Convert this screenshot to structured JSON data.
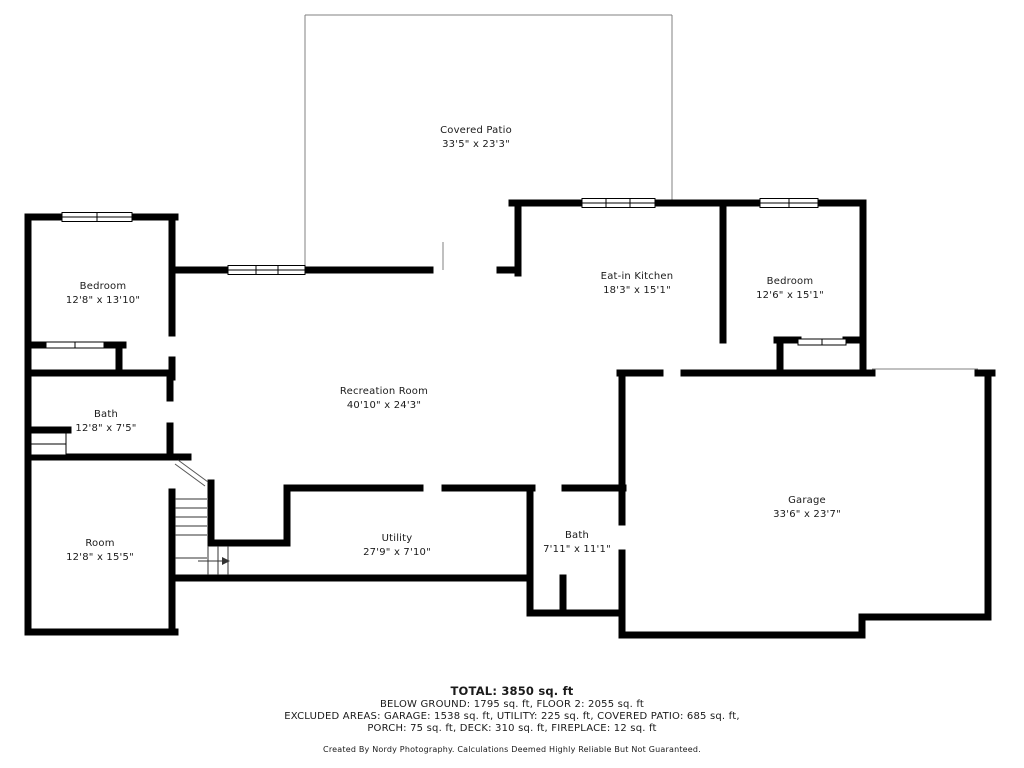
{
  "floorplan": {
    "rooms": {
      "covered_patio": {
        "name": "Covered Patio",
        "dims": "33'5\" x 23'3\""
      },
      "bedroom_left": {
        "name": "Bedroom",
        "dims": "12'8\" x 13'10\""
      },
      "eat_in_kitchen": {
        "name": "Eat-in Kitchen",
        "dims": "18'3\" x 15'1\""
      },
      "bedroom_right": {
        "name": "Bedroom",
        "dims": "12'6\" x 15'1\""
      },
      "recreation": {
        "name": "Recreation Room",
        "dims": "40'10\" x 24'3\""
      },
      "bath_left": {
        "name": "Bath",
        "dims": "12'8\" x 7'5\""
      },
      "room": {
        "name": "Room",
        "dims": "12'8\" x 15'5\""
      },
      "utility": {
        "name": "Utility",
        "dims": "27'9\" x 7'10\""
      },
      "bath_center": {
        "name": "Bath",
        "dims": "7'11\" x 11'1\""
      },
      "garage": {
        "name": "Garage",
        "dims": "33'6\" x 23'7\""
      }
    },
    "summary": {
      "total": "TOTAL: 3850 sq. ft",
      "line2": "BELOW GROUND: 1795 sq. ft, FLOOR 2: 2055 sq. ft",
      "line3": "EXCLUDED AREAS: GARAGE: 1538 sq. ft, UTILITY: 225 sq. ft, COVERED PATIO: 685 sq. ft,",
      "line4": "PORCH: 75 sq. ft, DECK: 310 sq. ft, FIREPLACE: 12 sq. ft",
      "credit": "Created By Nordy Photography. Calculations Deemed Highly Reliable But Not Guaranteed."
    },
    "colors": {
      "wall": "#000000",
      "patio_line": "#808080",
      "text": "#1a1a1a"
    }
  }
}
